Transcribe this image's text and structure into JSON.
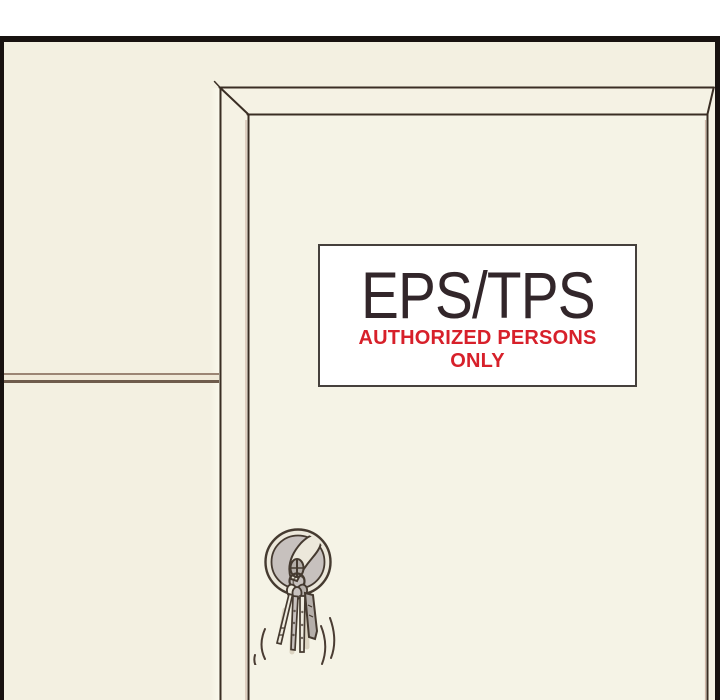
{
  "panel": {
    "kind": "comic-panel"
  },
  "sign": {
    "title": "EPS/TPS",
    "warning_line1": "AUTHORIZED PERSONS",
    "warning_line2": "ONLY"
  },
  "icons": {
    "keyhole": "keyhole-escutcheon-icon",
    "inserted_key": "inserted-key-icon",
    "key_ring": "key-ring-icon",
    "key_bunch": "key-bunch-icon",
    "motion_lines": "motion-lines-icon"
  },
  "colors": {
    "outside": "#ffffff",
    "border": "#181210",
    "wall": "#f3f0e1",
    "wall_light": "#faf8ec",
    "band": "#f5f2e4",
    "door": "#f5f3e6",
    "line": "#3a2e24",
    "line_soft": "#c9ab9c",
    "trim_top": "#9b8574",
    "trim_fill": "#f0ead9",
    "trim_bottom": "#6f5c4c",
    "sign_bg": "#ffffff",
    "sign_border": "#45403c",
    "title": "#32262a",
    "warning": "#d7202a",
    "metal_light": "#ece8db",
    "metal_mid": "#c7c1be",
    "metal_dark": "#453a30",
    "key_gray": "#b5afaa",
    "key_fill": "#efebdf",
    "shadow_soft": "#dcd4c2",
    "motion": "#4a3c33"
  }
}
